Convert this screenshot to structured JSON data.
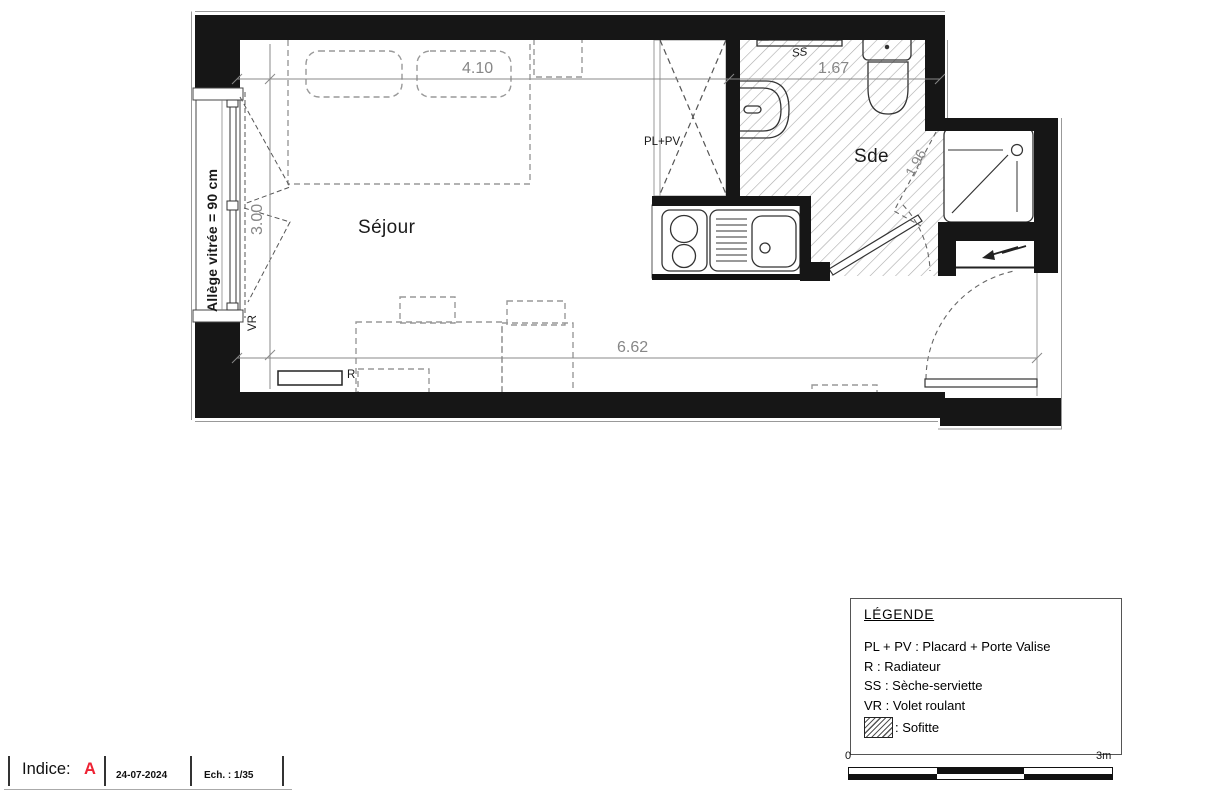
{
  "plan": {
    "rooms": {
      "sejour": "Séjour",
      "sde": "Sde"
    },
    "labels": {
      "pl_pv": "PL+PV",
      "ss": "SS",
      "r": "R",
      "vr": "VR",
      "allege": "Allège vitrée = 90 cm"
    },
    "dimensions": {
      "width_sejour": "4.10",
      "width_sde": "1.67",
      "height_left": "3.00",
      "width_total": "6.62",
      "depth_sde": "1.96"
    }
  },
  "legend": {
    "title": "LÉGENDE",
    "items": [
      "PL + PV : Placard + Porte Valise",
      "R : Radiateur",
      "SS : Sèche-serviette",
      "VR : Volet roulant"
    ],
    "sofitte": ": Sofitte",
    "sofitte_symbol": "hatch-swatch"
  },
  "title_block": {
    "indice_label": "Indice:",
    "indice_value": "A",
    "indice_color": "#ee2233",
    "date": "24-07-2024",
    "scale": "Ech. : 1/35"
  },
  "scale_bar": {
    "start": "0",
    "end": "3m"
  }
}
